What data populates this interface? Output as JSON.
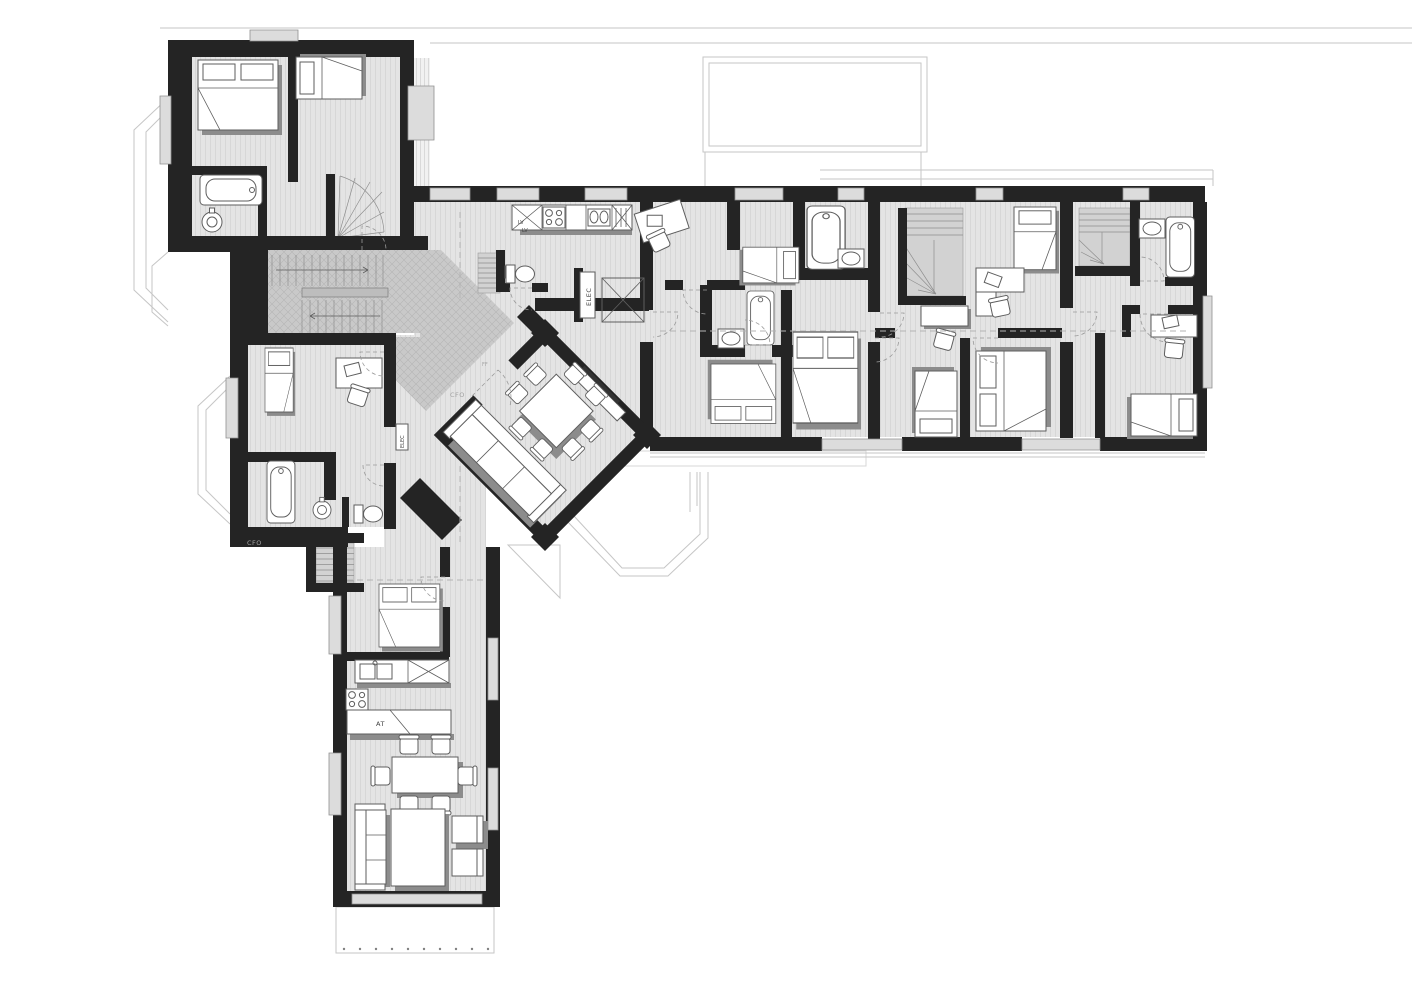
{
  "plan": {
    "labels": {
      "elec_closet": "ELEC",
      "elec_shaft": "ELEC",
      "lv_upper": "LV",
      "lv_lower": "LV",
      "counter_island": "AT",
      "cfo_hall": "CFO",
      "cfo_stairhall": "CFO",
      "ff_hall": "FF"
    },
    "colors": {
      "paper": "#ffffff",
      "wall": "#242424",
      "floor": "#e4e4e4",
      "stripe": "#d7d7d7",
      "hall": "#c9c9c9",
      "hallhatch": "#b6b6b6",
      "ffill": "#ffffff",
      "fstroke": "#5e5e5e",
      "shadow": "#8c8c8c",
      "winfill": "#dcdcdc",
      "winstroke": "#909090",
      "roof": "#c6c6c6",
      "terr": "#f1f1f1",
      "terrline": "#d9d9d9",
      "stair": "#d2d2d2",
      "tread": "#8f8f8f",
      "label": "#3f3f3f",
      "faint": "#a2a2a2"
    }
  }
}
